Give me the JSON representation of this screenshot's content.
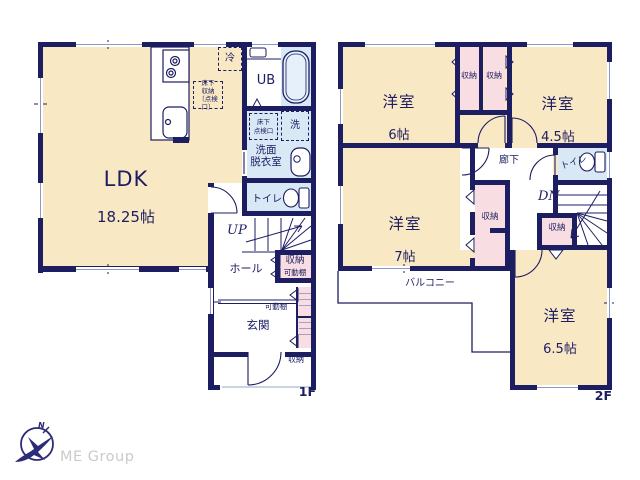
{
  "colors": {
    "wall": "#1d1d62",
    "room_cream": "#f9e8c4",
    "water_blue": "#d9e8f5",
    "closet_pink": "#f8dee2",
    "logo_text": "#cbcbcb"
  },
  "floor1": {
    "floor_label": "1F",
    "ldk": {
      "name": "LDK",
      "size": "18.25帖"
    },
    "refrigerator": "冷",
    "underfloor_storage": "床下\n収納\n〔点検口〕",
    "unit_bath": "UB",
    "underfloor_hatch": "床下\n点検口",
    "washer": "洗",
    "washroom": "洗面\n脱衣室",
    "toilet": "トイレ",
    "stairs_up": "UP",
    "hall": "ホール",
    "stair_storage": {
      "label": "収納",
      "shelf": "可動棚"
    },
    "entrance": {
      "label": "玄関",
      "shelf": "可動棚",
      "storage": "収納"
    }
  },
  "floor2": {
    "floor_label": "2F",
    "room6": {
      "name": "洋室",
      "size": "6帖"
    },
    "closet_a": "収納",
    "closet_b": "収納",
    "room45": {
      "name": "洋室",
      "size": "4.5帖"
    },
    "corridor": "廊下",
    "toilet": "トイレ",
    "stairs_down": "DN",
    "closet_tall": "収納",
    "closet_small": "収納",
    "room7": {
      "name": "洋室",
      "size": "7帖"
    },
    "balcony": "バルコニー",
    "room65": {
      "name": "洋室",
      "size": "6.5帖"
    }
  },
  "logo": {
    "company": "ME Group",
    "compass_north": "N"
  }
}
